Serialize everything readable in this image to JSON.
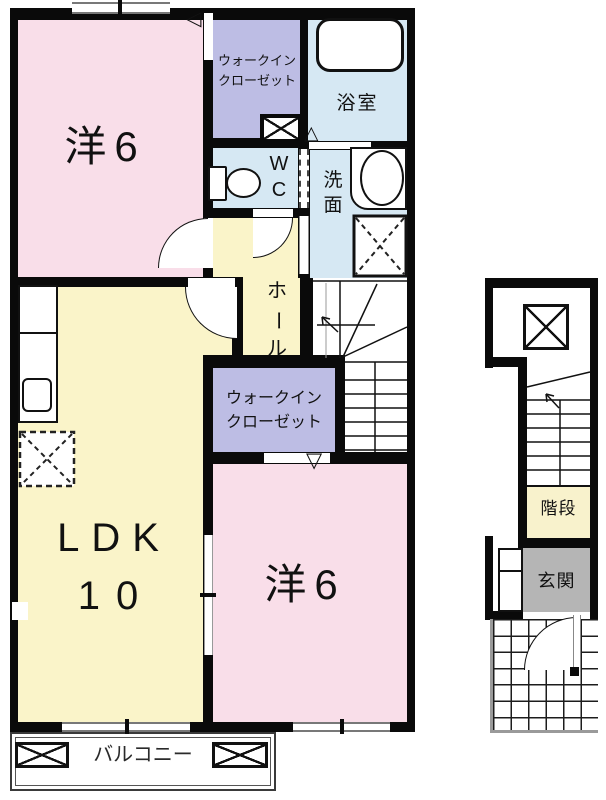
{
  "title": "2F apartment floor plan",
  "colors": {
    "wall": "#0a0a0a",
    "room_pink": "#f9dee9",
    "room_yellow": "#faf4c9",
    "room_lavender": "#bdbde4",
    "room_blue": "#d6e8f3",
    "stair_cream": "#f8f2cc",
    "entrance_gray": "#b5b5b5",
    "window_gray": "#787878"
  },
  "unit": {
    "bedroom_top": {
      "label": "洋6"
    },
    "walkin_closet_top": {
      "line1": "ウォークイン",
      "line2": "クローゼット"
    },
    "bath": {
      "label": "浴室"
    },
    "wc": {
      "line1": "W",
      "line2": "C"
    },
    "washroom": {
      "char1": "洗",
      "char2": "面"
    },
    "hall": {
      "char1": "ホ",
      "char2": "ー",
      "char3": "ル"
    },
    "walkin_closet_bottom": {
      "line1": "ウォークイン",
      "line2": "クローゼット"
    },
    "ldk": {
      "line1": "LDK",
      "line2": "10"
    },
    "bedroom_bottom": {
      "label": "洋6"
    },
    "balcony": {
      "label": "バルコニー"
    }
  },
  "annex": {
    "stairs": {
      "label": "階段"
    },
    "entrance": {
      "label": "玄関"
    }
  },
  "icons": {
    "door_left_triangle": "◁",
    "door_up_triangle": "△",
    "door_down_triangle": "▽"
  }
}
